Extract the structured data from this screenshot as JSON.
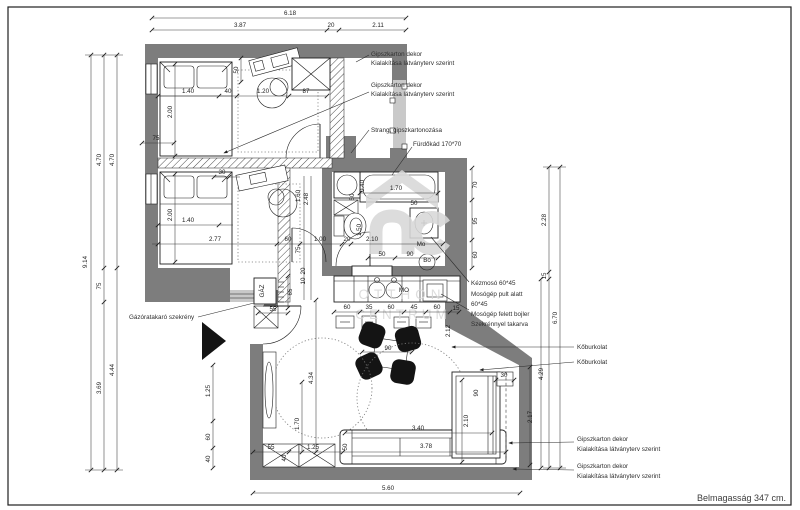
{
  "footer": {
    "text": "Belmagasság 347 cm."
  },
  "watermark": {
    "line1": "OTTHON",
    "line2": "CENTRUM"
  },
  "colors": {
    "wall": "#7d7d7d",
    "light_band": "#c9c9c9",
    "line": "#1f1f1f",
    "watermark": "#d8d8d8",
    "chair": "#141414",
    "background": "#ffffff"
  },
  "annotations": {
    "gips_top1_l1": "Gipszkarton dekor",
    "gips_top1_l2": "Kialakítása látványterv szerint",
    "gips_top2_l1": "Gipszkarton dekor",
    "gips_top2_l2": "Kialakítása látványterv szerint",
    "strang": "Strang, gipszkartonozása",
    "furdokad": "Fürdőkád 170*70",
    "kezmoso": "Kézmosó 60*45",
    "mosogep1_l1": "Mosógép pult alatt",
    "mosogep1_l2": "60*45",
    "mosogep2_l1": "Mosógép felett bojler",
    "mosogep2_l2": "Szekrénnyel takarva",
    "koburkolat1": "Kőburkolat",
    "koburkolat2": "Kőburkolat",
    "gips_bot1_l1": "Gipszkarton dekor",
    "gips_bot1_l2": "Kialakítása látványterv szerint",
    "gips_bot2_l1": "Gipszkarton dekor",
    "gips_bot2_l2": "Kialakítása látványterv szerint",
    "gazora": "Gázóratakaró szekrény"
  },
  "dims": [
    {
      "t": "6.18",
      "x": 290,
      "y": 15
    },
    {
      "t": "3.87",
      "x": 240,
      "y": 27
    },
    {
      "t": "20",
      "x": 331,
      "y": 27
    },
    {
      "t": "2.11",
      "x": 378,
      "y": 27
    },
    {
      "t": "9.14",
      "x": 87,
      "y": 262,
      "r": 1
    },
    {
      "t": "4.70",
      "x": 101,
      "y": 160,
      "r": 1
    },
    {
      "t": "4.70",
      "x": 114,
      "y": 160,
      "r": 1
    },
    {
      "t": "75",
      "x": 101,
      "y": 286,
      "r": 1
    },
    {
      "t": "3.69",
      "x": 101,
      "y": 388,
      "r": 1
    },
    {
      "t": "4.44",
      "x": 114,
      "y": 370,
      "r": 1
    },
    {
      "t": "1.40",
      "x": 188,
      "y": 93
    },
    {
      "t": "40",
      "x": 228,
      "y": 93
    },
    {
      "t": "1.20",
      "x": 263,
      "y": 93
    },
    {
      "t": "87",
      "x": 306,
      "y": 93
    },
    {
      "t": "50",
      "x": 238,
      "y": 70,
      "r": 1
    },
    {
      "t": "2.00",
      "x": 172,
      "y": 112,
      "r": 1
    },
    {
      "t": "75",
      "x": 156,
      "y": 140
    },
    {
      "t": "30",
      "x": 222,
      "y": 174
    },
    {
      "t": "1.40",
      "x": 188,
      "y": 222
    },
    {
      "t": "2.00",
      "x": 172,
      "y": 215,
      "r": 1
    },
    {
      "t": "2.77",
      "x": 215,
      "y": 241
    },
    {
      "t": "60",
      "x": 288,
      "y": 241
    },
    {
      "t": "1.00",
      "x": 320,
      "y": 241
    },
    {
      "t": "20",
      "x": 347,
      "y": 241
    },
    {
      "t": "1.60",
      "x": 300,
      "y": 196,
      "r": 1
    },
    {
      "t": "2.48",
      "x": 308,
      "y": 199,
      "r": 1
    },
    {
      "t": "75",
      "x": 300,
      "y": 250,
      "r": 1
    },
    {
      "t": "20",
      "x": 305,
      "y": 271,
      "r": 1
    },
    {
      "t": "10",
      "x": 305,
      "y": 281,
      "r": 1
    },
    {
      "t": "65",
      "x": 292,
      "y": 292,
      "r": 1
    },
    {
      "t": "GÁZ",
      "x": 264,
      "y": 291,
      "r": 1
    },
    {
      "t": "55",
      "x": 273,
      "y": 311
    },
    {
      "t": "1.70",
      "x": 396,
      "y": 190
    },
    {
      "t": "0.40",
      "x": 364,
      "y": 186,
      "r": 1
    },
    {
      "t": "50",
      "x": 354,
      "y": 197,
      "r": 1
    },
    {
      "t": "50",
      "x": 414,
      "y": 205
    },
    {
      "t": "1.50",
      "x": 361,
      "y": 230,
      "r": 1
    },
    {
      "t": "2.10",
      "x": 372,
      "y": 241
    },
    {
      "t": "Mo",
      "x": 421,
      "y": 246
    },
    {
      "t": "50",
      "x": 382,
      "y": 256
    },
    {
      "t": "90",
      "x": 410,
      "y": 256
    },
    {
      "t": "Bo",
      "x": 427,
      "y": 262
    },
    {
      "t": "70",
      "x": 477,
      "y": 185,
      "r": 1
    },
    {
      "t": "95",
      "x": 477,
      "y": 221,
      "r": 1
    },
    {
      "t": "60",
      "x": 477,
      "y": 255,
      "r": 1
    },
    {
      "t": "MO",
      "x": 404,
      "y": 292
    },
    {
      "t": "60",
      "x": 347,
      "y": 309
    },
    {
      "t": "35",
      "x": 369,
      "y": 309
    },
    {
      "t": "60",
      "x": 391,
      "y": 309
    },
    {
      "t": "45",
      "x": 414,
      "y": 309
    },
    {
      "t": "60",
      "x": 437,
      "y": 309
    },
    {
      "t": "15",
      "x": 456,
      "y": 310
    },
    {
      "t": "2.12",
      "x": 450,
      "y": 331,
      "r": 1
    },
    {
      "t": "90",
      "x": 388,
      "y": 350
    },
    {
      "t": "4.34",
      "x": 313,
      "y": 378,
      "r": 1
    },
    {
      "t": "1.70",
      "x": 299,
      "y": 424,
      "r": 1
    },
    {
      "t": "1.25",
      "x": 210,
      "y": 391,
      "r": 1
    },
    {
      "t": "60",
      "x": 210,
      "y": 437,
      "r": 1
    },
    {
      "t": "40",
      "x": 210,
      "y": 459,
      "r": 1
    },
    {
      "t": "55",
      "x": 271,
      "y": 449
    },
    {
      "t": "1.25",
      "x": 313,
      "y": 449
    },
    {
      "t": "3.40",
      "x": 418,
      "y": 430
    },
    {
      "t": "3.78",
      "x": 426,
      "y": 448
    },
    {
      "t": "50",
      "x": 347,
      "y": 447,
      "r": 1
    },
    {
      "t": "40",
      "x": 286,
      "y": 458,
      "r": 1
    },
    {
      "t": "5.60",
      "x": 388,
      "y": 490
    },
    {
      "t": "30",
      "x": 504,
      "y": 377
    },
    {
      "t": "90",
      "x": 478,
      "y": 393,
      "r": 1
    },
    {
      "t": "2.10",
      "x": 468,
      "y": 421,
      "r": 1
    },
    {
      "t": "2.17",
      "x": 532,
      "y": 417,
      "r": 1
    },
    {
      "t": "4.29",
      "x": 543,
      "y": 374,
      "r": 1
    },
    {
      "t": "2.28",
      "x": 546,
      "y": 220,
      "r": 1
    },
    {
      "t": "15",
      "x": 546,
      "y": 276,
      "r": 1
    },
    {
      "t": "6.70",
      "x": 557,
      "y": 318,
      "r": 1
    }
  ]
}
